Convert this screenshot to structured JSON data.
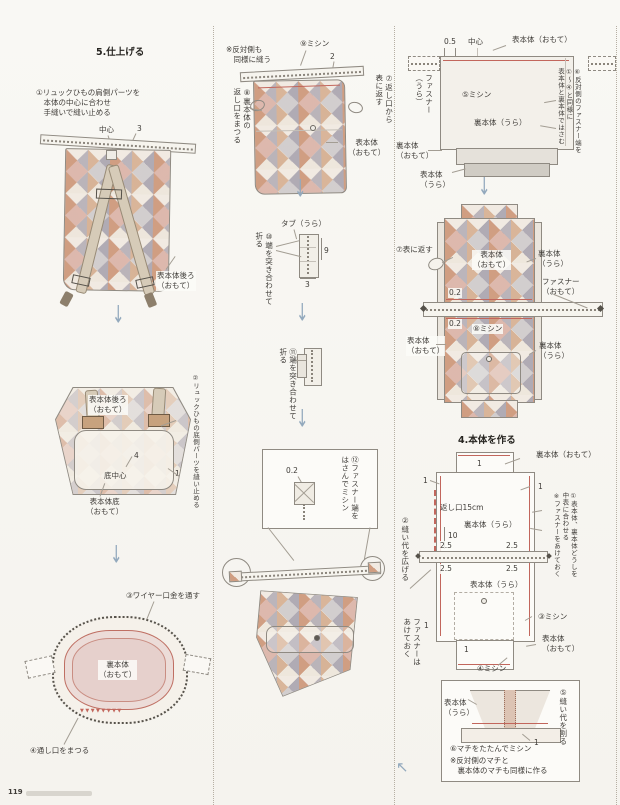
{
  "page": {
    "number": "119"
  },
  "colors": {
    "stitch_red": "#c2665c",
    "arrow_blue": "#93a9bd"
  },
  "icons": {
    "arrow_down": "↓",
    "arrow_up_left": "↖"
  },
  "s5": {
    "heading": "5.仕上げる",
    "step1": "①リュックひもの肩側パーツを\n　本体の中心に合わせ\n　手縫いで縫い止める",
    "center": "中心",
    "dim_3": "3",
    "label_back_omote": "表本体後ろ\n（おもて）",
    "step2_v": "②リュックひもの底側パーツを縫い止める",
    "label_bottom_center": "底中心",
    "dim_4": "4",
    "dim_1": "1",
    "label_bottom_omote": "表本体底\n（おもて）",
    "step3": "③ワイヤー口金を通す",
    "label_lining_omote": "裏本体\n（おもて）",
    "zigzag_stitches": "▼▼▼▼▼▼▼▼",
    "step4": "④通し口をまつる"
  },
  "mid": {
    "note_opposite": "※反対側も\n　同様に縫う",
    "step9": "⑨ミシン",
    "dim_2": "2",
    "step7_v": "⑦返し口から\n表に返す",
    "step8_v": "⑧裏本体の\n返し口をまつる",
    "label_outer_omote": "表本体\n（おもて）",
    "tab_ura": "タブ（うら）",
    "step10_v": "⑩端を突き合わせて\n折る",
    "dim_9": "9",
    "dim_3": "3",
    "step11_v": "⑪端を突き合わせて\n折る",
    "dim_02": "0.2",
    "step12_v": "⑫ファスナー端を\nはさんでミシン"
  },
  "s4top": {
    "dim_05": "0.5",
    "center": "中心",
    "label_outer_omote": "表本体（おもて）",
    "fastener_ura_v": "ファスナー\n（うら）",
    "step5": "⑤ミシン",
    "label_lining_ura": "裏本体（うら）",
    "label_lining_omote": "裏本体\n（おもて）",
    "label_outer_ura": "表本体\n（うら）",
    "step6_v": "⑥反対側のファスナー端を\n①～④と同様に\n表本体と裏本体ではさむ"
  },
  "s4mid": {
    "step7": "⑦表に返す",
    "label_outer_omote_top": "表本体\n（おもて）",
    "label_lining_ura_top": "裏本体\n（うら）",
    "fastener_omote": "ファスナー\n（おもて）",
    "dim_02a": "0.2",
    "dim_02b": "0.2",
    "step8": "⑧ミシン",
    "label_outer_omote_btm": "表本体\n（おもて）",
    "label_lining_ura_btm": "裏本体\n（うら）"
  },
  "s4": {
    "heading": "4.本体を作る",
    "label_lining_omote": "裏本体（おもて）",
    "dim_1": "1",
    "opening": "返し口15cm",
    "label_lining_ura": "裏本体（うら）",
    "dim_10": "10",
    "dim_25": "2.5",
    "label_outer_ura": "表本体（うら）",
    "step2_v": "②縫い代を広げる",
    "fastener_open_v": "ファスナーは\nあけておく",
    "step1_v": "①表本体、裏本体どうしを\n中表に合わせる\n※ファスナーをあけておく",
    "step3": "③ミシン",
    "label_outer_omote": "表本体\n（おもて）",
    "step4": "④ミシン"
  },
  "s4g": {
    "label_outer_ura": "表本体\n（うら）",
    "step5_v": "⑤縫い代を割る",
    "step6": "⑥マチをたたんでミシン",
    "note": "※反対側のマチと\n　裏本体のマチも同様に作る",
    "dim_1": "1"
  }
}
